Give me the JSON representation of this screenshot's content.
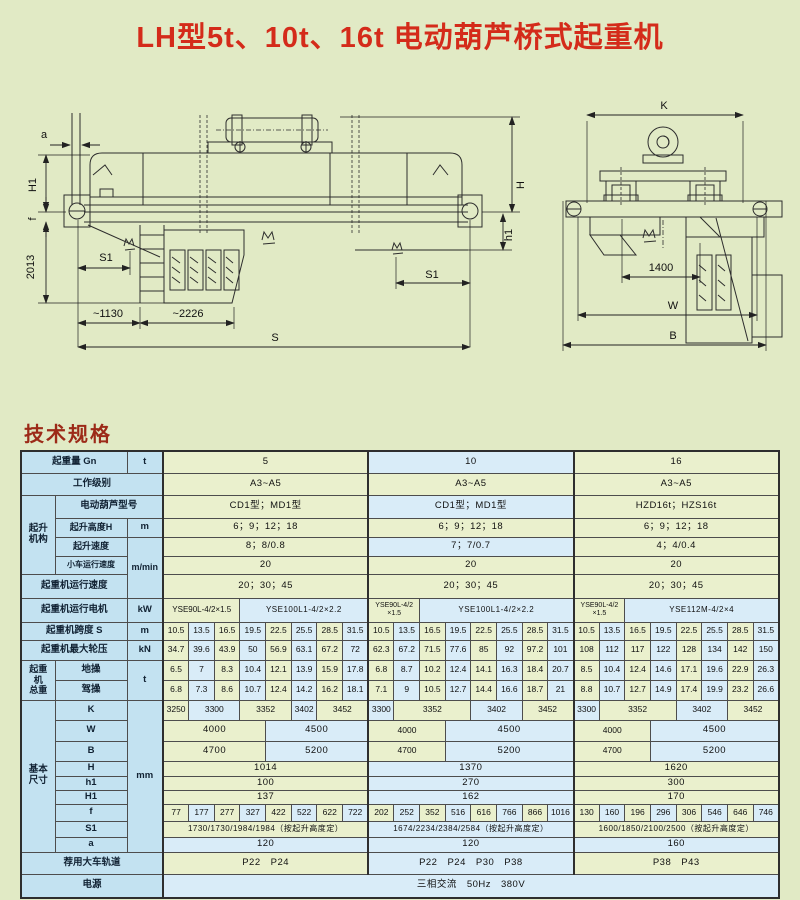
{
  "header": {
    "title": "LH型5t、10t、16t 电动葫芦桥式起重机"
  },
  "section": {
    "heading": "技术规格"
  },
  "colors": {
    "g": "#eaf0cd",
    "b": "#d9ecf8",
    "l": "#c3e2f1",
    "w": "#f2f6ee",
    "page_bg": "#e1eac5",
    "title_red": "#d42b1a",
    "heading_red": "#9c2a18",
    "line": "#2d2d2d"
  },
  "drawing": {
    "left_view": {
      "labels": {
        "a": "a",
        "H1": "H1",
        "f": "f",
        "dim_2013": "2013",
        "S1_left": "S1",
        "dim_1130": "~1130",
        "dim_2226": "~2226",
        "S": "S",
        "H": "H",
        "h1": "h1",
        "S1_right": "S1"
      }
    },
    "right_view": {
      "labels": {
        "K": "K",
        "dim_1400": "1400",
        "W": "W",
        "B": "B"
      }
    }
  },
  "table": {
    "rows": [
      [
        {
          "t": "起重量 Gn",
          "c": 2,
          "bg": "l"
        },
        {
          "t": "t",
          "bg": "l"
        },
        {
          "t": "5",
          "c": 8,
          "bg": "g"
        },
        {
          "t": "10",
          "c": 8,
          "bg": "b"
        },
        {
          "t": "16",
          "c": 8,
          "bg": "g"
        }
      ],
      [
        {
          "t": "工作级别",
          "c": 3,
          "bg": "l"
        },
        {
          "t": "A3~A5",
          "c": 8,
          "bg": "g"
        },
        {
          "t": "A3~A5",
          "c": 8,
          "bg": "g"
        },
        {
          "t": "A3~A5",
          "c": 8,
          "bg": "g"
        }
      ],
      [
        {
          "t": "起升\n机构",
          "r": 4,
          "bg": "l"
        },
        {
          "t": "电动葫芦型号",
          "c": 2,
          "bg": "l"
        },
        {
          "t": "CD1型；MD1型",
          "c": 8,
          "bg": "g"
        },
        {
          "t": "CD1型；MD1型",
          "c": 8,
          "bg": "b"
        },
        {
          "t": "HZD16t；HZS16t",
          "c": 8,
          "bg": "g"
        }
      ],
      [
        {
          "t": "起升高度H",
          "bg": "l",
          "sz": 9
        },
        {
          "t": "m",
          "bg": "l"
        },
        {
          "t": "6；9；12；18",
          "c": 8,
          "bg": "g"
        },
        {
          "t": "6；9；12；18",
          "c": 8,
          "bg": "g"
        },
        {
          "t": "6；9；12；18",
          "c": 8,
          "bg": "g"
        }
      ],
      [
        {
          "t": "起升速度",
          "bg": "l",
          "sz": 9
        },
        {
          "t": "m/min",
          "r": 3,
          "bg": "l",
          "sz": 9
        },
        {
          "t": "8；8/0.8",
          "c": 8,
          "bg": "g"
        },
        {
          "t": "7；7/0.7",
          "c": 8,
          "bg": "b"
        },
        {
          "t": "4；4/0.4",
          "c": 8,
          "bg": "g"
        }
      ],
      [
        {
          "t": "小车运行速度",
          "bg": "l",
          "sz": 8
        },
        {
          "t": "20",
          "c": 8,
          "bg": "g"
        },
        {
          "t": "20",
          "c": 8,
          "bg": "g"
        },
        {
          "t": "20",
          "c": 8,
          "bg": "g"
        }
      ],
      [
        {
          "t": "起重机运行速度",
          "c": 2,
          "bg": "l"
        },
        {
          "t": "20；30；45",
          "c": 8,
          "bg": "g"
        },
        {
          "t": "20；30；45",
          "c": 8,
          "bg": "g"
        },
        {
          "t": "20；30；45",
          "c": 8,
          "bg": "g"
        }
      ],
      [
        {
          "t": "起重机运行电机",
          "c": 2,
          "bg": "l"
        },
        {
          "t": "kW",
          "bg": "l"
        },
        {
          "t": "YSE90L-4/2×1.5",
          "c": 3,
          "bg": "g",
          "sz": 8
        },
        {
          "t": "YSE100L1-4/2×2.2",
          "c": 5,
          "bg": "b",
          "sz": 8
        },
        {
          "t": "YSE90L-4/2\n×1.5",
          "c": 2,
          "bg": "g",
          "sz": 7
        },
        {
          "t": "YSE100L1-4/2×2.2",
          "c": 6,
          "bg": "b",
          "sz": 8
        },
        {
          "t": "YSE90L-4/2\n×1.5",
          "c": 2,
          "bg": "g",
          "sz": 7
        },
        {
          "t": "YSE112M-4/2×4",
          "c": 6,
          "bg": "b",
          "sz": 8
        }
      ],
      [
        {
          "t": "起重机跨度 S",
          "c": 2,
          "bg": "l"
        },
        {
          "t": "m",
          "bg": "l"
        },
        {
          "t": "10.5"
        },
        {
          "t": "13.5"
        },
        {
          "t": "16.5"
        },
        {
          "t": "19.5"
        },
        {
          "t": "22.5"
        },
        {
          "t": "25.5"
        },
        {
          "t": "28.5"
        },
        {
          "t": "31.5"
        },
        {
          "t": "10.5"
        },
        {
          "t": "13.5"
        },
        {
          "t": "16.5"
        },
        {
          "t": "19.5"
        },
        {
          "t": "22.5"
        },
        {
          "t": "25.5"
        },
        {
          "t": "28.5"
        },
        {
          "t": "31.5"
        },
        {
          "t": "10.5"
        },
        {
          "t": "13.5"
        },
        {
          "t": "16.5"
        },
        {
          "t": "19.5"
        },
        {
          "t": "22.5"
        },
        {
          "t": "25.5"
        },
        {
          "t": "28.5"
        },
        {
          "t": "31.5"
        }
      ],
      [
        {
          "t": "起重机最大轮压",
          "c": 2,
          "bg": "l"
        },
        {
          "t": "kN",
          "bg": "l"
        },
        {
          "t": "34.7"
        },
        {
          "t": "39.6"
        },
        {
          "t": "43.9"
        },
        {
          "t": "50"
        },
        {
          "t": "56.9"
        },
        {
          "t": "63.1"
        },
        {
          "t": "67.2"
        },
        {
          "t": "72"
        },
        {
          "t": "62.3"
        },
        {
          "t": "67.2"
        },
        {
          "t": "71.5"
        },
        {
          "t": "77.6"
        },
        {
          "t": "85"
        },
        {
          "t": "92"
        },
        {
          "t": "97.2"
        },
        {
          "t": "101"
        },
        {
          "t": "108"
        },
        {
          "t": "112"
        },
        {
          "t": "117"
        },
        {
          "t": "122"
        },
        {
          "t": "128"
        },
        {
          "t": "134"
        },
        {
          "t": "142"
        },
        {
          "t": "150"
        }
      ],
      [
        {
          "t": "起重\n机\n总重",
          "r": 2,
          "bg": "l",
          "sz": 9
        },
        {
          "t": "地操",
          "bg": "l"
        },
        {
          "t": "t",
          "r": 2,
          "bg": "l"
        },
        {
          "t": "6.5"
        },
        {
          "t": "7"
        },
        {
          "t": "8.3"
        },
        {
          "t": "10.4"
        },
        {
          "t": "12.1"
        },
        {
          "t": "13.9"
        },
        {
          "t": "15.9"
        },
        {
          "t": "17.8"
        },
        {
          "t": "6.8"
        },
        {
          "t": "8.7"
        },
        {
          "t": "10.2"
        },
        {
          "t": "12.4"
        },
        {
          "t": "14.1"
        },
        {
          "t": "16.3"
        },
        {
          "t": "18.4"
        },
        {
          "t": "20.7"
        },
        {
          "t": "8.5"
        },
        {
          "t": "10.4"
        },
        {
          "t": "12.4"
        },
        {
          "t": "14.6"
        },
        {
          "t": "17.1"
        },
        {
          "t": "19.6"
        },
        {
          "t": "22.9"
        },
        {
          "t": "26.3"
        }
      ],
      [
        {
          "t": "驾操",
          "bg": "l"
        },
        {
          "t": "6.8"
        },
        {
          "t": "7.3"
        },
        {
          "t": "8.6"
        },
        {
          "t": "10.7"
        },
        {
          "t": "12.4"
        },
        {
          "t": "14.2"
        },
        {
          "t": "16.2"
        },
        {
          "t": "18.1"
        },
        {
          "t": "7.1"
        },
        {
          "t": "9"
        },
        {
          "t": "10.5"
        },
        {
          "t": "12.7"
        },
        {
          "t": "14.4"
        },
        {
          "t": "16.6"
        },
        {
          "t": "18.7"
        },
        {
          "t": "21"
        },
        {
          "t": "8.8"
        },
        {
          "t": "10.7"
        },
        {
          "t": "12.7"
        },
        {
          "t": "14.9"
        },
        {
          "t": "17.4"
        },
        {
          "t": "19.9"
        },
        {
          "t": "23.2"
        },
        {
          "t": "26.6"
        }
      ],
      [
        {
          "t": "基本\n尺寸",
          "r": 9,
          "bg": "l"
        },
        {
          "t": "K",
          "bg": "l"
        },
        {
          "t": "mm",
          "r": 9,
          "bg": "l"
        },
        {
          "t": "3250",
          "bg": "g"
        },
        {
          "t": "3300",
          "c": 2,
          "bg": "b"
        },
        {
          "t": "3352",
          "c": 2,
          "bg": "g"
        },
        {
          "t": "3402",
          "bg": "b"
        },
        {
          "t": "3452",
          "c": 2,
          "bg": "g"
        },
        {
          "t": "3300",
          "bg": "b"
        },
        {
          "t": "3352",
          "c": 3,
          "bg": "g"
        },
        {
          "t": "3402",
          "c": 2,
          "bg": "b"
        },
        {
          "t": "3452",
          "c": 2,
          "bg": "g"
        },
        {
          "t": "3300",
          "bg": "b"
        },
        {
          "t": "3352",
          "c": 3,
          "bg": "g"
        },
        {
          "t": "3402",
          "c": 2,
          "bg": "b"
        },
        {
          "t": "3452",
          "c": 2,
          "bg": "g"
        }
      ],
      [
        {
          "t": "W",
          "bg": "l"
        },
        {
          "t": "4000",
          "c": 4,
          "bg": "g"
        },
        {
          "t": "4500",
          "c": 4,
          "bg": "b"
        },
        {
          "t": "4000",
          "c": 3,
          "bg": "g"
        },
        {
          "t": "4500",
          "c": 5,
          "bg": "b"
        },
        {
          "t": "4000",
          "c": 3,
          "bg": "g"
        },
        {
          "t": "4500",
          "c": 5,
          "bg": "b"
        }
      ],
      [
        {
          "t": "B",
          "bg": "l"
        },
        {
          "t": "4700",
          "c": 4,
          "bg": "g"
        },
        {
          "t": "5200",
          "c": 4,
          "bg": "b"
        },
        {
          "t": "4700",
          "c": 3,
          "bg": "g"
        },
        {
          "t": "5200",
          "c": 5,
          "bg": "b"
        },
        {
          "t": "4700",
          "c": 3,
          "bg": "g"
        },
        {
          "t": "5200",
          "c": 5,
          "bg": "b"
        }
      ],
      [
        {
          "t": "H",
          "bg": "l"
        },
        {
          "t": "1014",
          "c": 8,
          "bg": "g"
        },
        {
          "t": "1370",
          "c": 8,
          "bg": "b"
        },
        {
          "t": "1620",
          "c": 8,
          "bg": "g"
        }
      ],
      [
        {
          "t": "h1",
          "bg": "l"
        },
        {
          "t": "100",
          "c": 8,
          "bg": "g"
        },
        {
          "t": "270",
          "c": 8,
          "bg": "b"
        },
        {
          "t": "300",
          "c": 8,
          "bg": "g"
        }
      ],
      [
        {
          "t": "H1",
          "bg": "l"
        },
        {
          "t": "137",
          "c": 8,
          "bg": "g"
        },
        {
          "t": "162",
          "c": 8,
          "bg": "b"
        },
        {
          "t": "170",
          "c": 8,
          "bg": "g"
        }
      ],
      [
        {
          "t": "f",
          "bg": "l"
        },
        {
          "t": "77"
        },
        {
          "t": "177"
        },
        {
          "t": "277"
        },
        {
          "t": "327"
        },
        {
          "t": "422"
        },
        {
          "t": "522"
        },
        {
          "t": "622"
        },
        {
          "t": "722"
        },
        {
          "t": "202"
        },
        {
          "t": "252"
        },
        {
          "t": "352"
        },
        {
          "t": "516"
        },
        {
          "t": "616"
        },
        {
          "t": "766"
        },
        {
          "t": "866"
        },
        {
          "t": "1016"
        },
        {
          "t": "130"
        },
        {
          "t": "160"
        },
        {
          "t": "196"
        },
        {
          "t": "296"
        },
        {
          "t": "306"
        },
        {
          "t": "546"
        },
        {
          "t": "646"
        },
        {
          "t": "746"
        }
      ],
      [
        {
          "t": "S1",
          "bg": "l"
        },
        {
          "t": "1730/1730/1984/1984（按起升高度定）",
          "c": 8,
          "bg": "g",
          "sz": 8
        },
        {
          "t": "1674/2234/2384/2584（按起升高度定）",
          "c": 8,
          "bg": "b",
          "sz": 8
        },
        {
          "t": "1600/1850/2100/2500（按起升高度定）",
          "c": 8,
          "bg": "g",
          "sz": 8
        }
      ],
      [
        {
          "t": "a",
          "bg": "l"
        },
        {
          "t": "120",
          "c": 8,
          "bg": "b"
        },
        {
          "t": "120",
          "c": 8,
          "bg": "b"
        },
        {
          "t": "160",
          "c": 8,
          "bg": "b"
        }
      ],
      [
        {
          "t": "荐用大车轨道",
          "c": 3,
          "bg": "l"
        },
        {
          "t": "P22　P24",
          "c": 8,
          "bg": "g"
        },
        {
          "t": "P22　P24　P30　P38",
          "c": 8,
          "bg": "b"
        },
        {
          "t": "P38　P43",
          "c": 8,
          "bg": "g"
        }
      ],
      [
        {
          "t": "电源",
          "c": 3,
          "bg": "l"
        },
        {
          "t": "三相交流　50Hz　380V",
          "c": 24,
          "bg": "b"
        }
      ]
    ]
  }
}
